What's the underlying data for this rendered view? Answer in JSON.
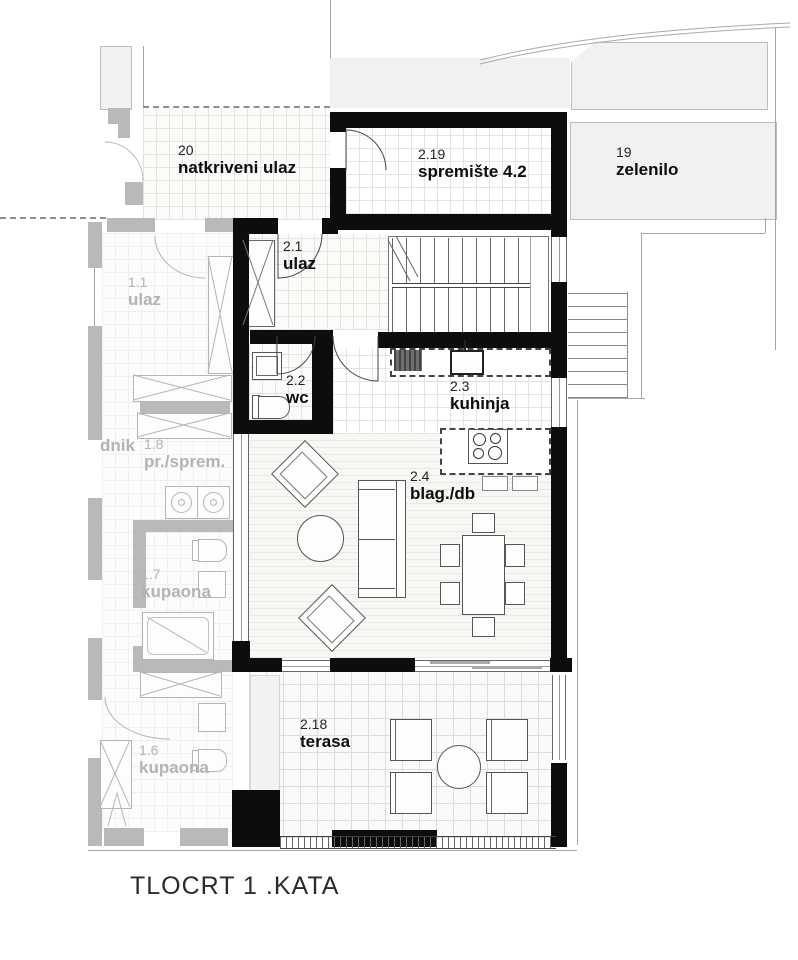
{
  "title": "TLOCRT 1 .KATA",
  "colors": {
    "wall_black": "#0d0d0d",
    "wall_gray": "#b9b9b9",
    "area_fill": "#f1f1ef",
    "text_black": "#0d0d0d",
    "text_gray": "#b3b3b3"
  },
  "rooms": {
    "natkriveni_ulaz": {
      "number": "20",
      "name": "natkriveni ulaz"
    },
    "spremiste": {
      "number": "2.19",
      "name": "spremište 4.2"
    },
    "zelenilo": {
      "number": "19",
      "name": "zelenilo"
    },
    "ulaz": {
      "number": "2.1",
      "name": "ulaz"
    },
    "wc": {
      "number": "2.2",
      "name": "wc"
    },
    "kuhinja": {
      "number": "2.3",
      "name": "kuhinja"
    },
    "blag_db": {
      "number": "2.4",
      "name": "blag./db"
    },
    "terasa": {
      "number": "2.18",
      "name": "terasa"
    },
    "ulaz_11": {
      "number": "1.1",
      "name": "ulaz"
    },
    "hodnik": {
      "name": "dnik"
    },
    "pr_sprem": {
      "number": "1.8",
      "name": "pr./sprem."
    },
    "kupaona_17": {
      "number": "1.7",
      "name": "kupaona"
    },
    "kupaona_16": {
      "number": "1.6",
      "name": "kupaona"
    }
  }
}
